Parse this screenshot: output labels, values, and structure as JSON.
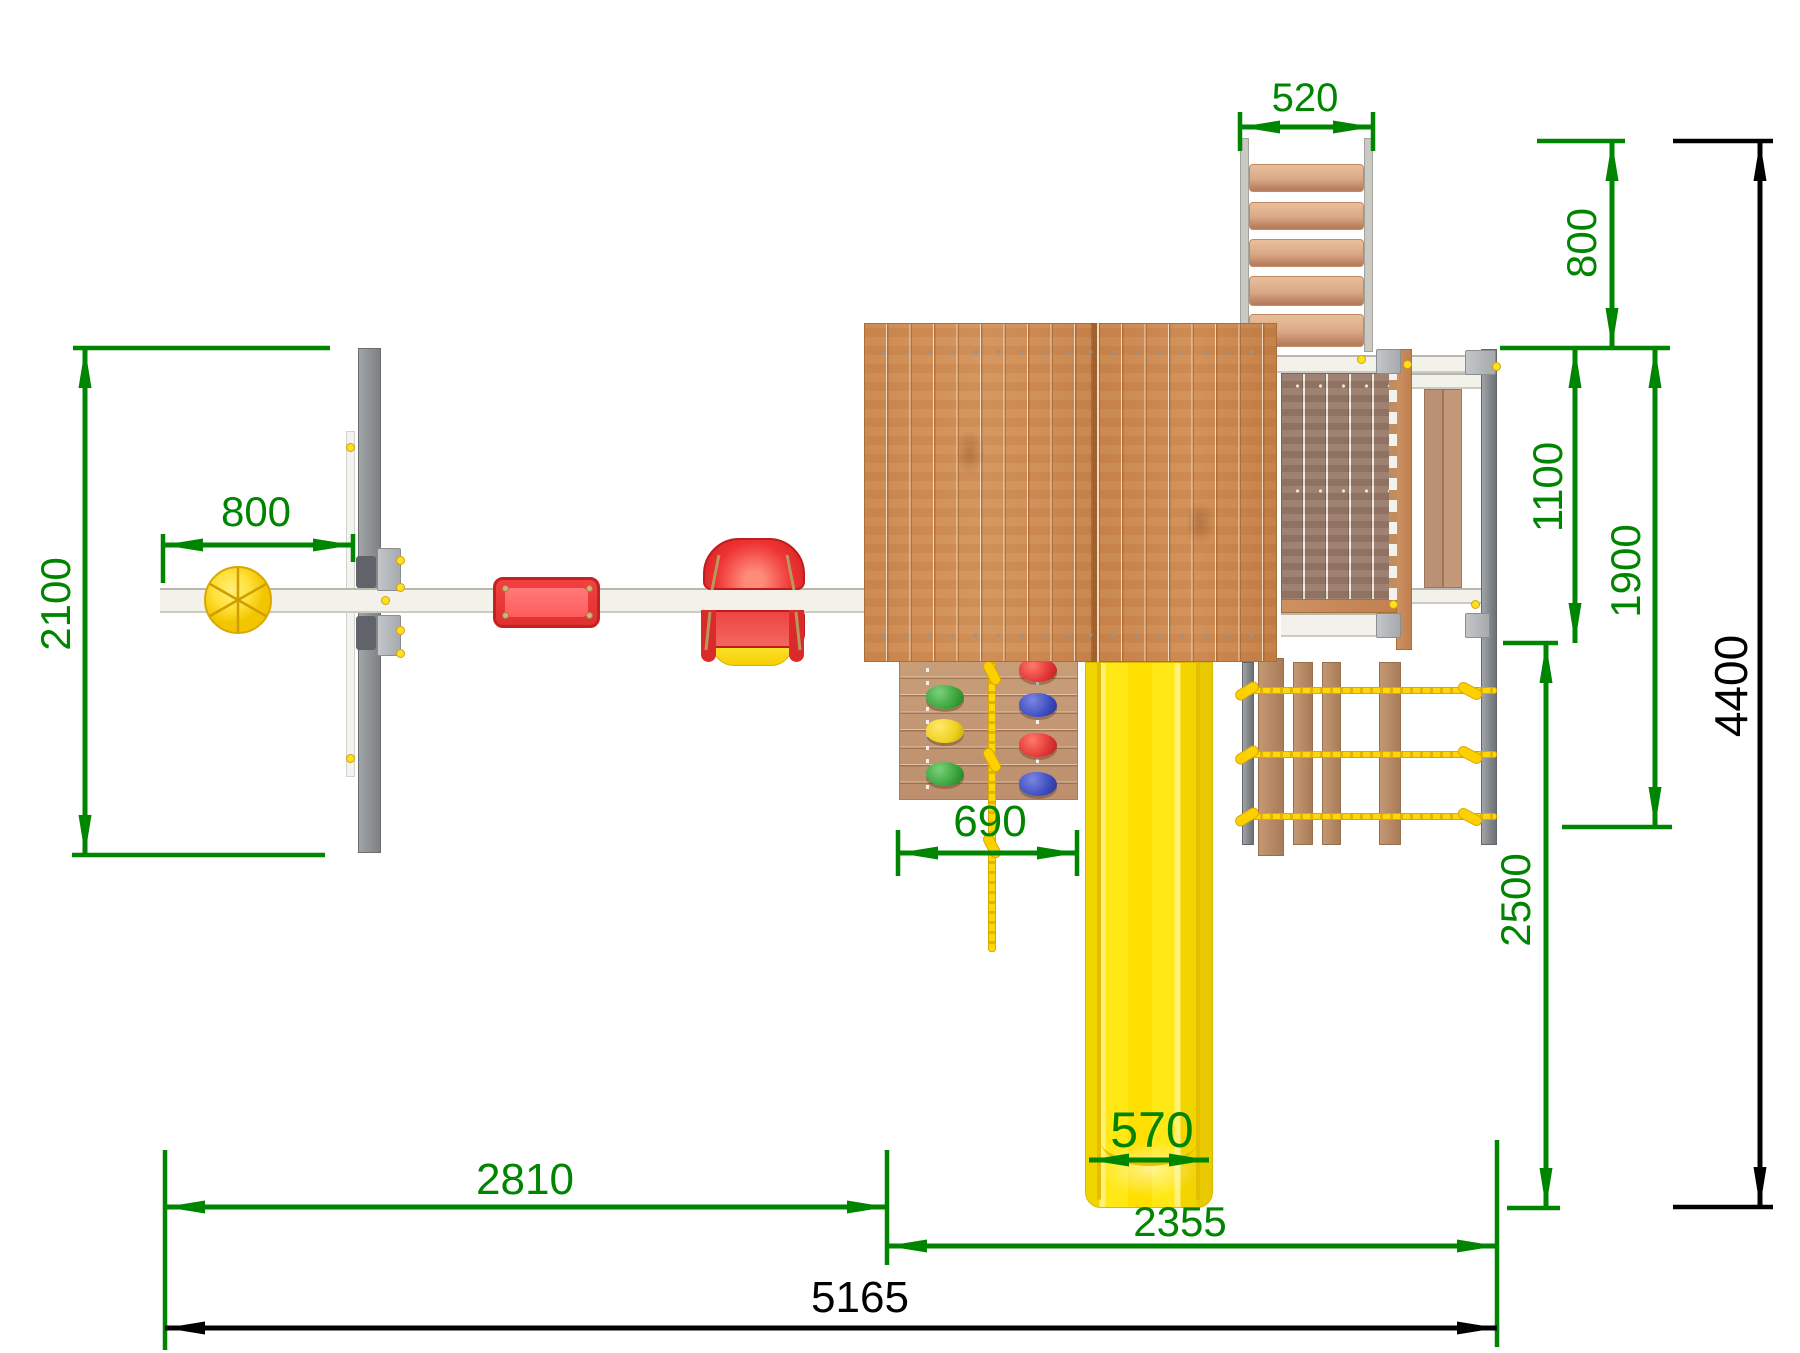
{
  "drawing": {
    "name": "playground-set-top-view-dimension-drawing",
    "units_implied": "mm"
  },
  "dimensions": {
    "ladder_width": "520",
    "upper_offset": "800",
    "deck_depth": "1100",
    "tower_depth": "1900",
    "total_depth": "4400",
    "lower_offset": "2500",
    "swing_depth": "2100",
    "hoop_offset": "800",
    "wall_width": "690",
    "slide_width": "570",
    "swing_length": "2810",
    "tower_length": "2355",
    "total_length": "5165"
  },
  "colors": {
    "dimension_green": "#008500",
    "dimension_black": "#000000",
    "roof_wood": "#c9854c",
    "deck_wood": "#97796a",
    "slide_yellow": "#ffe816",
    "rope_yellow": "#ffd60a",
    "seat_red": "#e23030",
    "frame_gray": "#84878a",
    "beam_white": "#f2f1ea"
  }
}
